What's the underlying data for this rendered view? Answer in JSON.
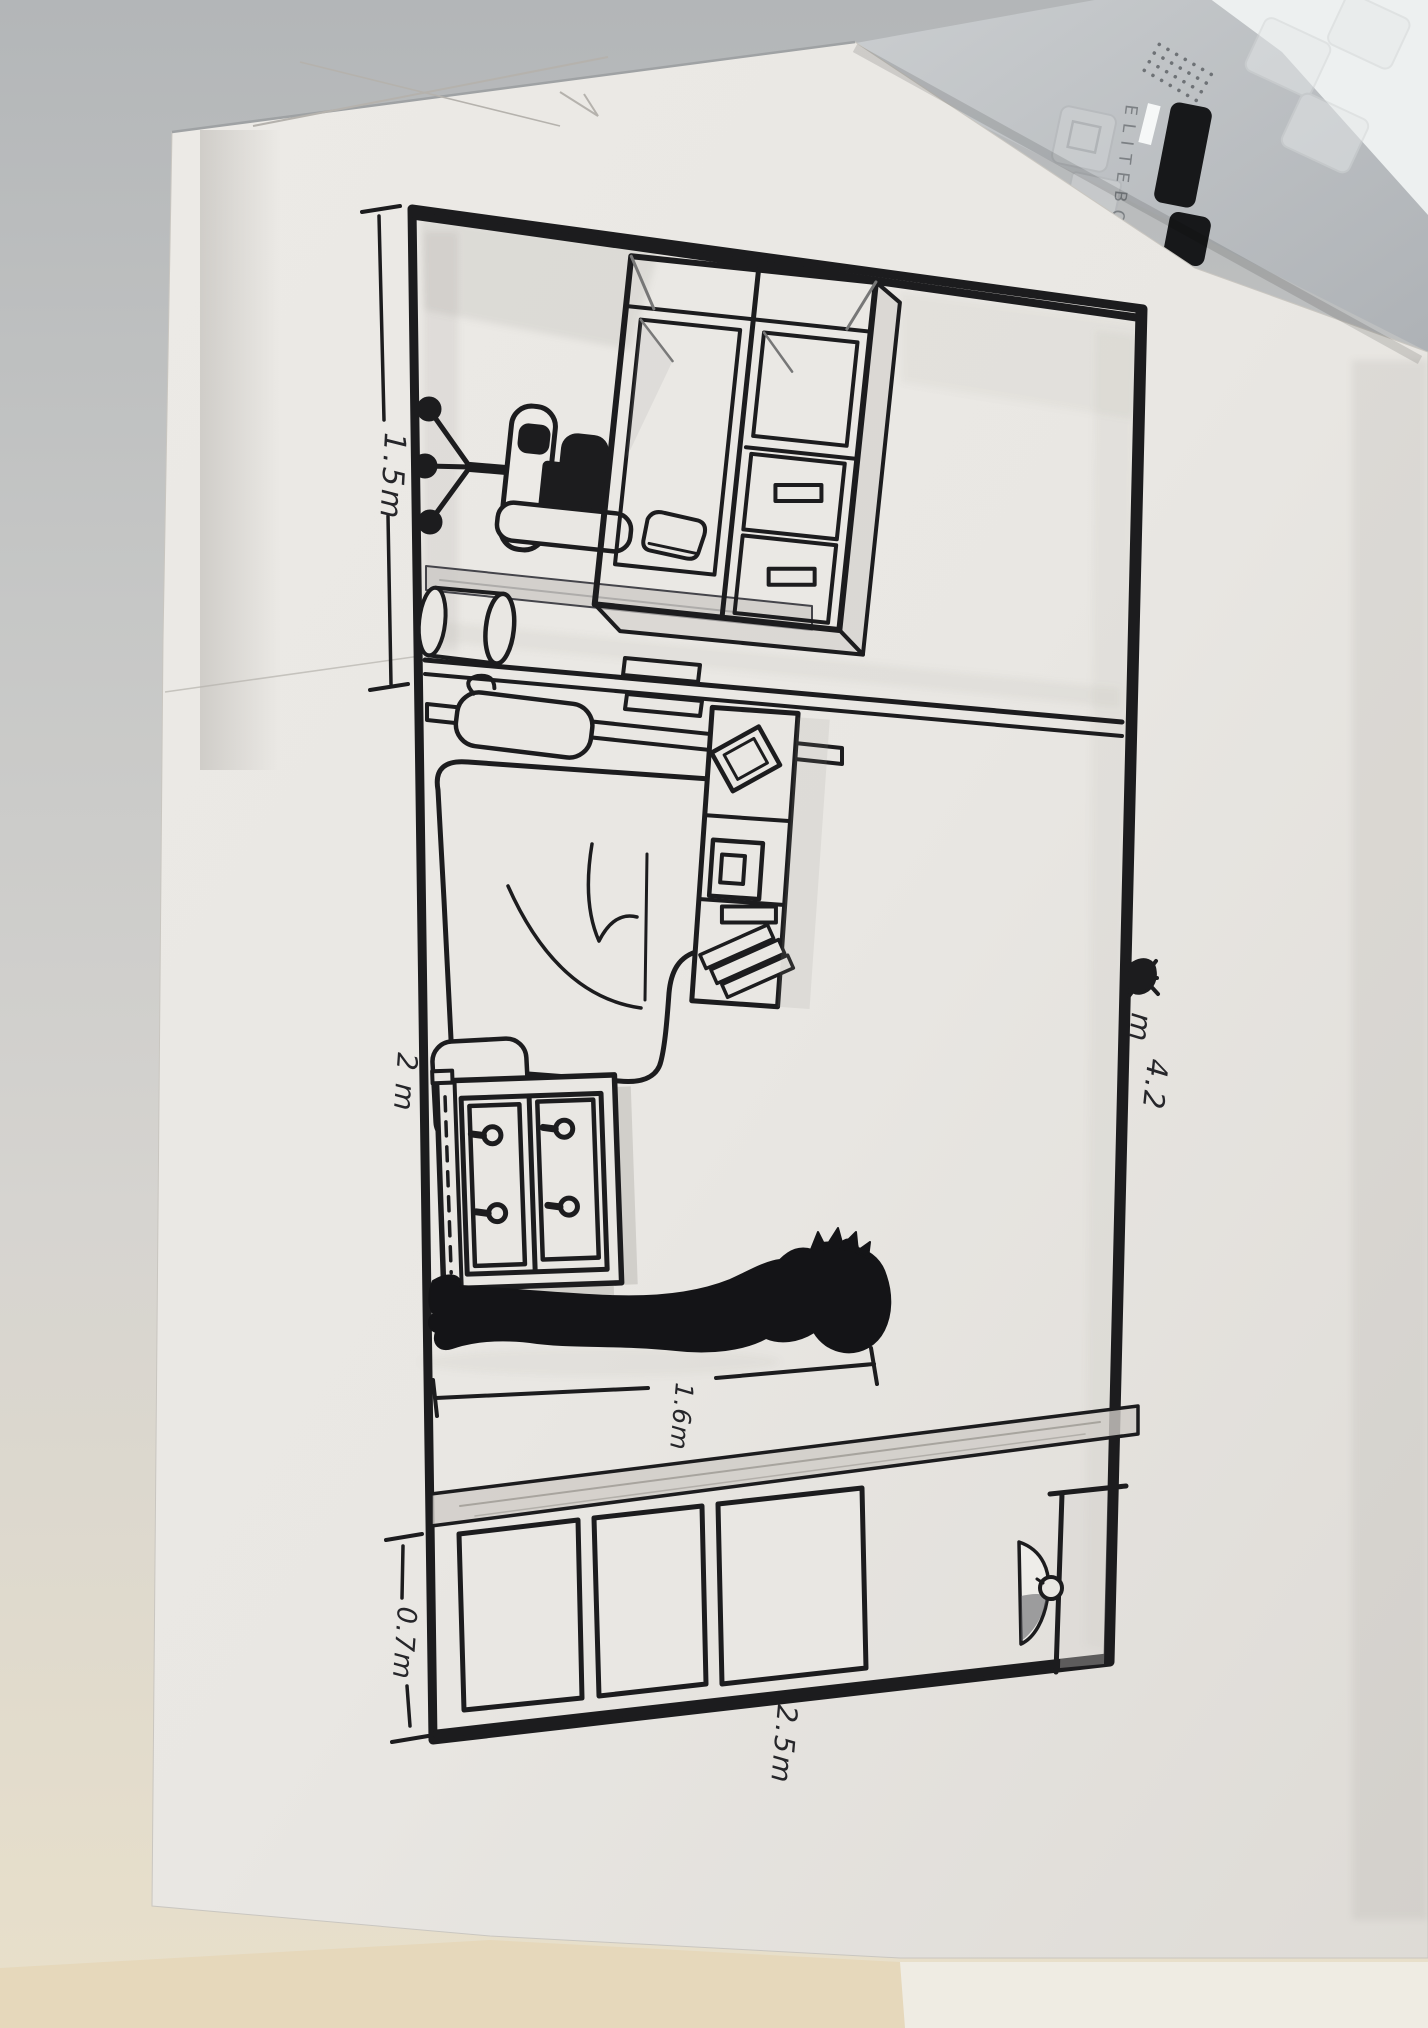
{
  "laptop": {
    "brand_text": "ELITEBOO",
    "deck_color": "#c2c5c8",
    "key_color": "#17181a"
  },
  "paper": {
    "color": "#e9e7e3"
  },
  "drawing": {
    "ink_color": "#1c1c1e",
    "labels": {
      "width_top": "1.5m",
      "width_middle": "2 m",
      "length_right_value": "4.2",
      "length_right_unit": "m",
      "person_height": "1.6m",
      "depth_bottom": "0.7m",
      "width_bottom": "2.5m"
    },
    "objects": "office chair, desk cabinet, waste bin, bed, pillow, bookshelf, dresser, person silhouette, closet rail, sliding panels, door, door handle"
  }
}
